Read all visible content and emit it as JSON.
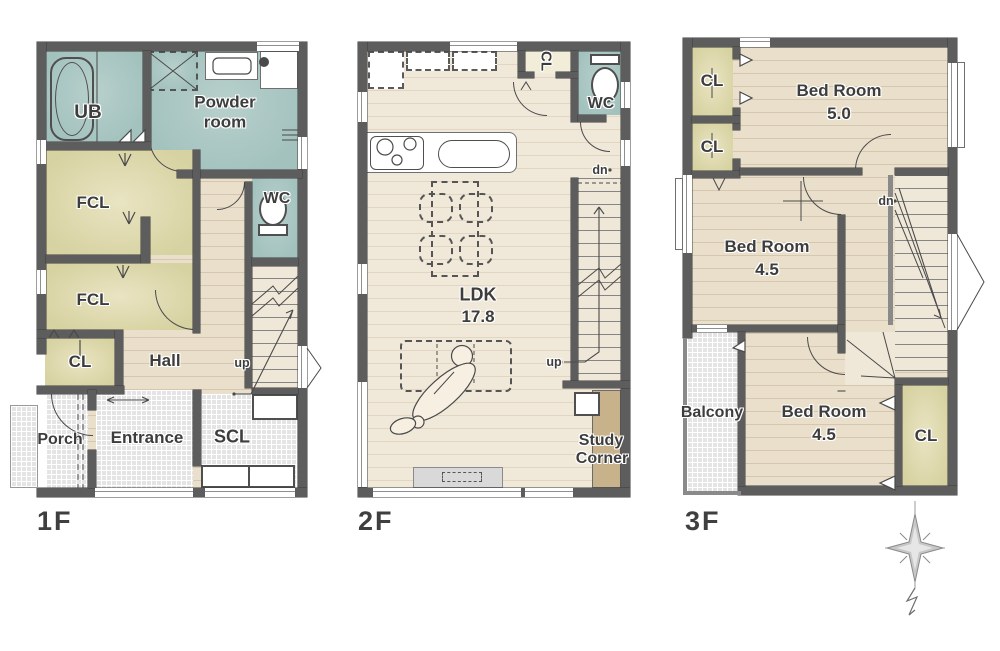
{
  "colors": {
    "wall": "#5d5d5d",
    "bath_teal": "#a3c2be",
    "closet_yellow": "#d7d2a1",
    "wood_floor": "#eadfcb",
    "ldk_floor": "#f0e9da",
    "tile_gray": "#e4e4e4",
    "desk_brown": "#c8b28c",
    "label_text": "#3d3d3d"
  },
  "floors": {
    "f1": {
      "title": "1F",
      "rooms": {
        "ub": "UB",
        "powder": "Powder room",
        "wc": "WC",
        "fcl_upper": "FCL",
        "fcl_lower": "FCL",
        "cl": "CL",
        "hall": "Hall",
        "porch": "Porch",
        "entrance": "Entrance",
        "scl": "SCL"
      },
      "stair_up": "up"
    },
    "f2": {
      "title": "2F",
      "rooms": {
        "cl": "CL",
        "wc": "WC",
        "ldk_name": "LDK",
        "ldk_size": "17.8",
        "study_line1": "Study",
        "study_line2": "Corner"
      },
      "stair_up": "up",
      "stair_dn": "dn"
    },
    "f3": {
      "title": "3F",
      "rooms": {
        "cl_top": "CL",
        "cl_mid": "CL",
        "cl_bottom": "CL",
        "bed1_name": "Bed Room",
        "bed1_size": "5.0",
        "bed2_name": "Bed Room",
        "bed2_size": "4.5",
        "bed3_name": "Bed Room",
        "bed3_size": "4.5",
        "balcony": "Balcony"
      },
      "stair_dn": "dn"
    }
  }
}
